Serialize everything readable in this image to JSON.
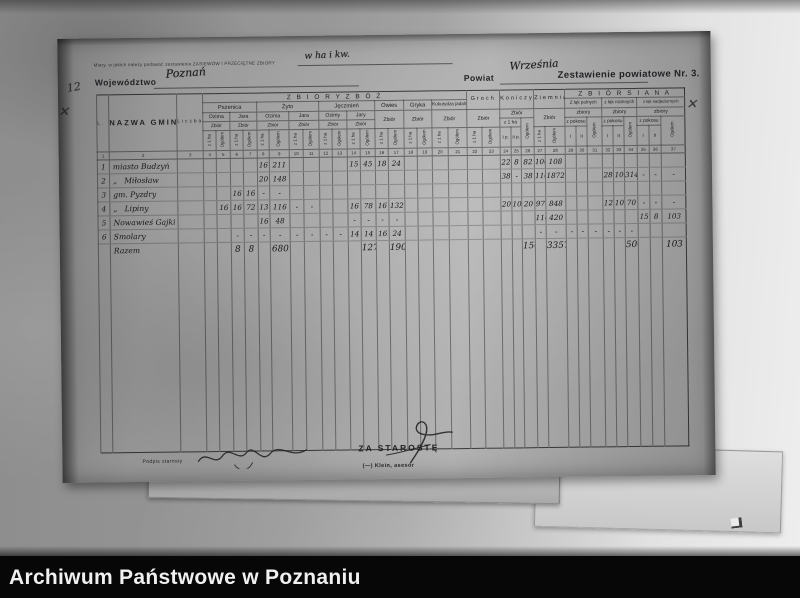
{
  "photo": {
    "archive_bar": {
      "label": "Archiwum Państwowe w Poznaniu"
    }
  },
  "annotations": {
    "corner_number": "12",
    "cross_mark_left": "✕",
    "cross_mark_right": "✕"
  },
  "form": {
    "measures_note": "Miary, w jakich należy podawać zestawienia ZASIEWÓW I PRZECIĘTNE ZBIORY",
    "measures_value": "w ha i kw.",
    "wojewodztwo_label": "Województwo",
    "wojewodztwo_value": "Poznań",
    "powiat_label": "Powiat",
    "powiat_value": "Września",
    "title": "Zestawienie powiatowe Nr. 3.",
    "table": {
      "header": {
        "lp": "L. p.",
        "nazwa": "NAZWA GMINY",
        "liczba": "Liczba gospodarstw",
        "zboz_title": "Z B I O R Y   Z B Ó Ż",
        "siana_title": "Z B I Ó R   S I A N A",
        "pszenica": "Pszenica",
        "zyto": "Żyto",
        "jeczmien": "Jęczmień",
        "owies": "Owies",
        "gryka": "Gryka",
        "kukurydza": "Kukurydza jadalna",
        "groch": "Groch",
        "koniczyna": "Koniczyna",
        "ziemniaki": "Ziemniaki",
        "ozima": "Ozima",
        "jara": "Jara",
        "ozimy": "Ozimy",
        "jary": "Jary",
        "zbior": "Zbiór",
        "zbiory": "zbiory",
        "z1ha": "z 1 ha",
        "ogolem": "Ogółem",
        "z_pokosu": "z pokosu",
        "ip": "I p.",
        "iip": "II p.",
        "i": "I",
        "ii": "II",
        "siana1": "Z łąk polnych",
        "siana2": "z łąk nizinnych",
        "siana3": "z łąk nadjeziornych"
      },
      "rows": [
        {
          "cls": "colnums",
          "lp": "1",
          "name": "2",
          "liczba": "3",
          "cells": [
            "4",
            "5",
            "6",
            "7",
            "8",
            "9",
            "10",
            "11",
            "12",
            "13",
            "14",
            "15",
            "16",
            "17",
            "18",
            "19",
            "20",
            "21",
            "22",
            "23",
            "24",
            "25",
            "26",
            "27",
            "28",
            "29",
            "30",
            "31",
            "32",
            "33",
            "34",
            "35",
            "36",
            "37"
          ]
        },
        {
          "cls": "hw",
          "lp": "1",
          "name": "miasto Budzyń",
          "liczba": "",
          "cells": [
            "",
            "",
            "",
            "",
            "16",
            "211",
            "",
            "",
            "",
            "",
            "15",
            "45",
            "18",
            "24",
            "",
            "",
            "",
            "",
            "",
            "",
            "22",
            "8",
            "82",
            "100",
            "108",
            "",
            "",
            "",
            "",
            "",
            "",
            "",
            "",
            ""
          ]
        },
        {
          "cls": "hw",
          "lp": "2",
          "name": "„   Miłosław",
          "liczba": "",
          "cells": [
            "",
            "",
            "",
            "",
            "20",
            "148",
            "",
            "",
            "",
            "",
            "",
            "",
            "",
            "",
            "",
            "",
            "",
            "",
            "",
            "",
            "38",
            "-",
            "38",
            "110",
            "1872",
            "",
            "",
            "",
            "28",
            "10",
            "314",
            "-",
            "-",
            "-"
          ]
        },
        {
          "cls": "hw",
          "lp": "3",
          "name": "gm. Pyzdry",
          "liczba": "",
          "cells": [
            "",
            "",
            "16",
            "16",
            "-",
            "-",
            "",
            "",
            "",
            "",
            "",
            "",
            "",
            "",
            "",
            "",
            "",
            "",
            "",
            "",
            "",
            "",
            "",
            "",
            "",
            "",
            "",
            "",
            "",
            "",
            "",
            "",
            "",
            ""
          ]
        },
        {
          "cls": "hw",
          "lp": "4",
          "name": "„   Lipiny",
          "liczba": "",
          "cells": [
            "",
            "16",
            "16",
            "72",
            "13",
            "116",
            "-",
            "-",
            "",
            "",
            "16",
            "78",
            "16",
            "132",
            "",
            "",
            "",
            "",
            "",
            "",
            "20",
            "10",
            "20",
            "97",
            "848",
            "",
            "",
            "",
            "12",
            "10",
            "70",
            "-",
            "-",
            "-"
          ]
        },
        {
          "cls": "hw",
          "lp": "5",
          "name": "Nowawieś Gajki",
          "liczba": "",
          "cells": [
            "",
            "",
            "",
            "",
            "16",
            "48",
            "",
            "",
            "",
            "",
            "-",
            "-",
            "-",
            "-",
            "",
            "",
            "",
            "",
            "",
            "",
            "",
            "",
            "",
            "110",
            "420",
            "",
            "",
            "",
            "",
            "",
            "",
            "15",
            "8",
            "103"
          ]
        },
        {
          "cls": "hw",
          "lp": "6",
          "name": "Smolary",
          "liczba": "",
          "cells": [
            "",
            "",
            "-",
            "-",
            "-",
            "-",
            "-",
            "-",
            "-",
            "-",
            "14",
            "14",
            "16",
            "24",
            "",
            "",
            "",
            "",
            "",
            "",
            "",
            "",
            "",
            "-",
            "-",
            "-",
            "-",
            "-",
            "-",
            "-",
            "-",
            "",
            "",
            ""
          ]
        },
        {
          "cls": "hw razem",
          "lp": "",
          "name": "Razem",
          "liczba": "",
          "cells": [
            "",
            "",
            "8",
            "8",
            "",
            "680",
            "",
            "",
            "",
            "",
            "",
            "127",
            "",
            "190",
            "",
            "",
            "",
            "",
            "",
            "",
            "",
            "",
            "150",
            "",
            "3357",
            "",
            "",
            "",
            "",
            "",
            "500",
            "",
            "",
            "103"
          ]
        }
      ]
    },
    "footer": {
      "podpis_label": "Podpis starosty",
      "za_staroste": "ZA STAROSTĘ",
      "signed": "(—) Klein, asesor"
    }
  }
}
